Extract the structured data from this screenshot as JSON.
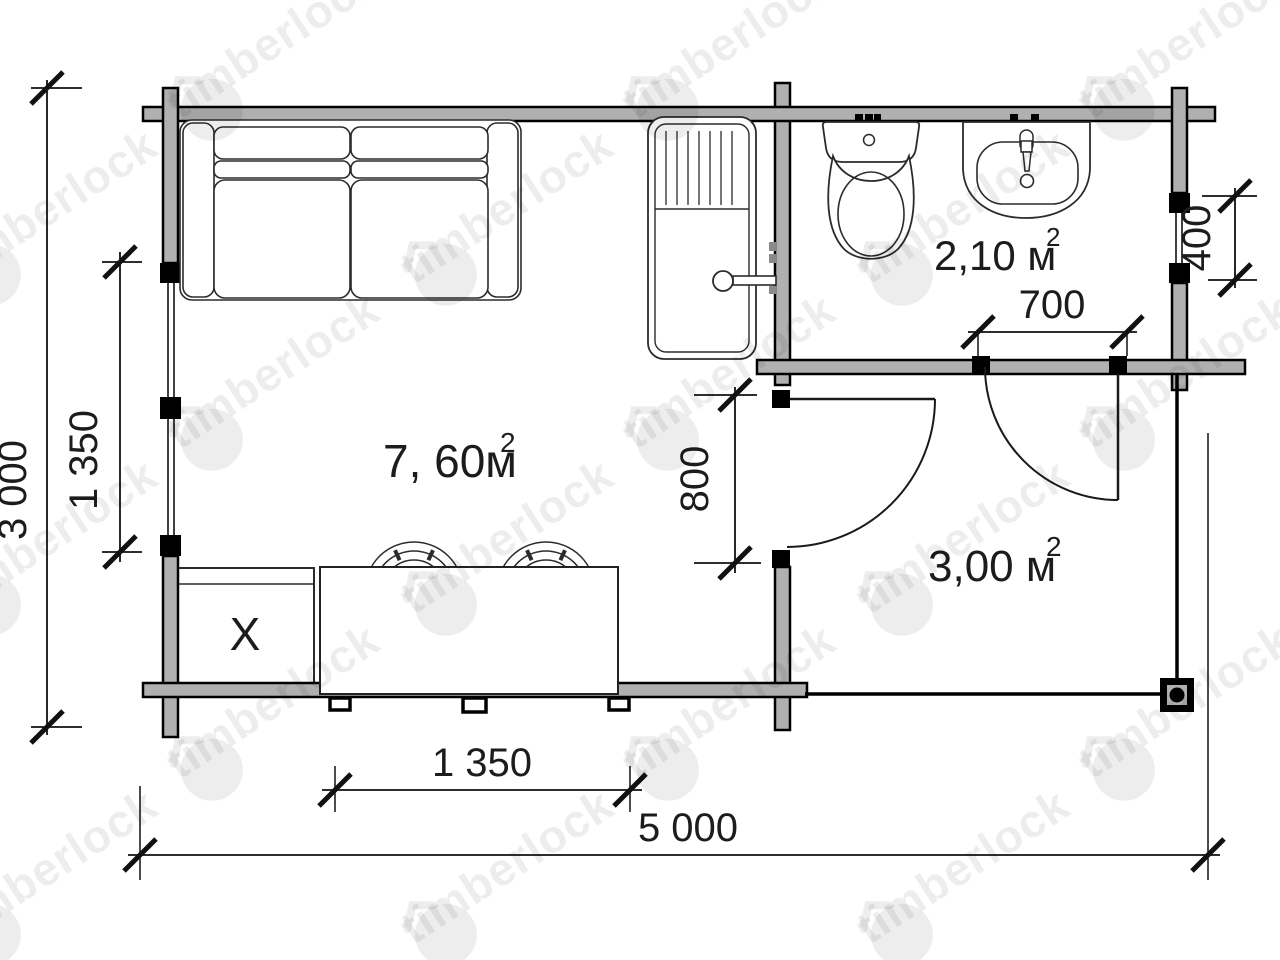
{
  "watermark": {
    "text": "timberlock"
  },
  "rooms": {
    "living": {
      "area_main": "7, 60м",
      "area_sup": "2"
    },
    "bathroom": {
      "area_main": "2,10 м",
      "area_sup": "2"
    },
    "terrace": {
      "area_main": "3,00 м",
      "area_sup": "2"
    }
  },
  "dimensions": {
    "overall_height": "3 000",
    "left_window": "1 350",
    "right_window": "400",
    "bathroom_door": "700",
    "terrace_door": "800",
    "kitchen_front": "1 350",
    "overall_width": "5 000"
  },
  "furniture": {
    "stove_label": "X",
    "items": [
      "sofa",
      "shower-cabin",
      "toilet",
      "washbasin",
      "kitchen-counter",
      "stove-box",
      "hob-burners"
    ]
  },
  "colors": {
    "wall_fill": "#b0b0b0",
    "line": "#1a1a1a",
    "watermark": "rgba(0,0,0,0.072)"
  }
}
